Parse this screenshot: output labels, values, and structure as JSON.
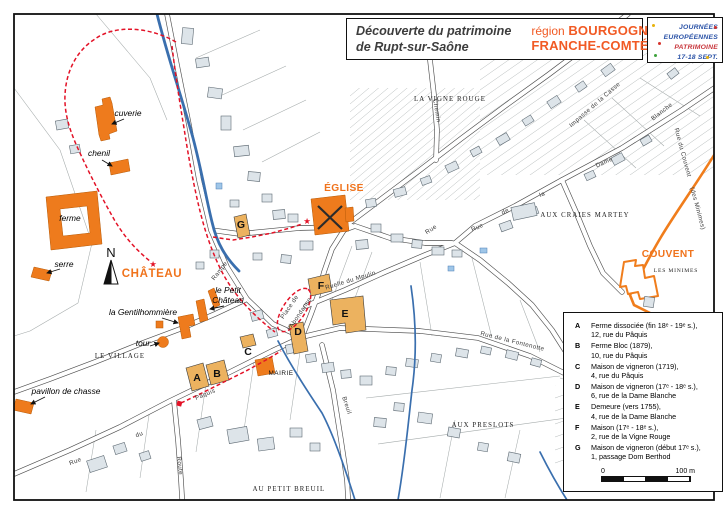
{
  "header": {
    "title_line1": "Découverte du patrimoine",
    "title_line2": "de Rupt-sur-Saône",
    "region_prefix": "région",
    "region_name1": "BOURGOGNE",
    "region_name2": "FRANCHE-COMTÉ",
    "accent_color": "#f15a24"
  },
  "logo": {
    "line1": "JOURNÉES",
    "line2": "EUROPÉENNES",
    "line3": "PATRIMOINE",
    "line4": "17-18 SEPT."
  },
  "legend": {
    "items": [
      {
        "letter": "A",
        "line1": "Ferme dissociée (fin 18ᵉ - 19ᵉ s.),",
        "line2": "12, rue du Pâquis"
      },
      {
        "letter": "B",
        "line1": "Ferme Bloc (1879),",
        "line2": "10, rue du Pâquis"
      },
      {
        "letter": "C",
        "line1": "Maison de vigneron (1719),",
        "line2": "4, rue du Pâquis"
      },
      {
        "letter": "D",
        "line1": "Maison de vigneron (17ᵉ - 18ᵉ s.),",
        "line2": "6, rue de la Dame Blanche"
      },
      {
        "letter": "E",
        "line1": "Demeure (vers 1755),",
        "line2": "4, rue de la Dame Blanche"
      },
      {
        "letter": "F",
        "line1": "Maison (17ᵉ - 18ᵉ s.),",
        "line2": "2, rue de la Vigne Rouge"
      },
      {
        "letter": "G",
        "line1": "Maison de vigneron (début 17ᵉ s.),",
        "line2": "1, passage Dom Berthod"
      }
    ],
    "scale_start": "0",
    "scale_end": "100 m"
  },
  "map": {
    "colors": {
      "heritage_orange": "#ee7b1d",
      "lettered_tan": "#ecb25f",
      "route_red": "#e31227",
      "water_blue": "#3a6fae",
      "building_gray": "#dde4e9"
    },
    "north_letter": "N",
    "building_letters": [
      {
        "letter": "A",
        "x": 197,
        "y": 381
      },
      {
        "letter": "B",
        "x": 217,
        "y": 377
      },
      {
        "letter": "C",
        "x": 248,
        "y": 355
      },
      {
        "letter": "D",
        "x": 298,
        "y": 335
      },
      {
        "letter": "E",
        "x": 345,
        "y": 317
      },
      {
        "letter": "F",
        "x": 321,
        "y": 289
      },
      {
        "letter": "G",
        "x": 241,
        "y": 228
      }
    ],
    "labels": [
      {
        "name": "label-chateau",
        "text": "CHÂTEAU",
        "x": 152,
        "y": 277,
        "cls": "poi-orange-lg"
      },
      {
        "name": "label-eglise",
        "text": "ÉGLISE",
        "x": 344,
        "y": 191,
        "cls": "poi-orange"
      },
      {
        "name": "label-couvent",
        "text": "COUVENT",
        "x": 668,
        "y": 257,
        "cls": "poi-orange"
      },
      {
        "name": "label-cuverie",
        "text": "cuverie",
        "x": 128,
        "y": 116,
        "cls": "poi"
      },
      {
        "name": "label-chenil",
        "text": "chenil",
        "x": 99,
        "y": 156,
        "cls": "poi"
      },
      {
        "name": "label-ferme",
        "text": "ferme",
        "x": 70,
        "y": 221,
        "cls": "poi"
      },
      {
        "name": "label-serre",
        "text": "serre",
        "x": 64,
        "y": 267,
        "cls": "poi"
      },
      {
        "name": "label-tour",
        "text": "tour",
        "x": 143,
        "y": 346,
        "cls": "poi"
      },
      {
        "name": "label-pavillon-de-chasse",
        "text": "pavillon de chasse",
        "x": 66,
        "y": 394,
        "cls": "poi"
      },
      {
        "name": "label-la-gentilhommiere",
        "text": "la Gentilhommière",
        "x": 143,
        "y": 315,
        "cls": "poi"
      },
      {
        "name": "label-le-petit-chateau-1",
        "text": "le Petit",
        "x": 228,
        "y": 293,
        "cls": "poi"
      },
      {
        "name": "label-le-petit-chateau-2",
        "text": "Château",
        "x": 228,
        "y": 303,
        "cls": "poi"
      },
      {
        "name": "label-mairie",
        "text": "MAIRIE",
        "x": 281,
        "y": 375,
        "cls": "mairie"
      },
      {
        "name": "label-le-village",
        "text": "LE VILLAGE",
        "x": 120,
        "y": 358,
        "cls": "area"
      },
      {
        "name": "label-la-vigne-rouge",
        "text": "LA VIGNE ROUGE",
        "x": 450,
        "y": 101,
        "cls": "area"
      },
      {
        "name": "label-aux-craies-martey",
        "text": "AUX CRAIES MARTEY",
        "x": 585,
        "y": 217,
        "cls": "area"
      },
      {
        "name": "label-aux-preslots",
        "text": "AUX PRESLOTS",
        "x": 483,
        "y": 427,
        "cls": "area"
      },
      {
        "name": "label-au-petit-breuil",
        "text": "AU PETIT BREUIL",
        "x": 289,
        "y": 491,
        "cls": "area"
      },
      {
        "name": "label-les-minimes",
        "text": "LES MINIMES",
        "x": 676,
        "y": 272,
        "cls": "area-sm"
      },
      {
        "name": "street-rampe",
        "text": "Rampe",
        "x": 221,
        "y": 272,
        "rot": -52,
        "cls": "street"
      },
      {
        "name": "street-paquis",
        "text": "Pâquis",
        "x": 206,
        "y": 396,
        "rot": -23,
        "cls": "street"
      },
      {
        "name": "street-du",
        "text": "du",
        "x": 140,
        "y": 436,
        "rot": -21,
        "cls": "street"
      },
      {
        "name": "street-rue",
        "text": "Rue",
        "x": 76,
        "y": 463,
        "rot": -21,
        "cls": "street"
      },
      {
        "name": "street-route",
        "text": "Route",
        "x": 178,
        "y": 466,
        "rot": 83,
        "cls": "street"
      },
      {
        "name": "street-breuil",
        "text": "Breuil",
        "x": 345,
        "y": 406,
        "rot": 72,
        "cls": "street"
      },
      {
        "name": "street-place-de",
        "text": "Place de",
        "x": 291,
        "y": 308,
        "rot": -56,
        "cls": "street"
      },
      {
        "name": "street-l-abondance",
        "text": "l'Abondance",
        "x": 301,
        "y": 315,
        "rot": -56,
        "cls": "street"
      },
      {
        "name": "street-ruelle-du-moulin",
        "text": "Ruelle  du  Moulin",
        "x": 351,
        "y": 282,
        "rot": -17,
        "cls": "street"
      },
      {
        "name": "street-rue-de-la-fontenotte",
        "text": "Rue  de  la  Fontenotte",
        "x": 512,
        "y": 343,
        "rot": 14,
        "cls": "street"
      },
      {
        "name": "street-rue-dame-blanche-1",
        "text": "Rue",
        "x": 478,
        "y": 229,
        "rot": -24,
        "cls": "street"
      },
      {
        "name": "street-rue-dame-blanche-2",
        "text": "de",
        "x": 506,
        "y": 213,
        "rot": -24,
        "cls": "street"
      },
      {
        "name": "street-rue-dame-blanche-3",
        "text": "la",
        "x": 543,
        "y": 196,
        "rot": -24,
        "cls": "street"
      },
      {
        "name": "street-rue-dame-blanche-4",
        "text": "Dame",
        "x": 605,
        "y": 164,
        "rot": -24,
        "cls": "street"
      },
      {
        "name": "street-rue-dame-blanche-5",
        "text": "Blanche",
        "x": 663,
        "y": 113,
        "rot": -38,
        "cls": "street"
      },
      {
        "name": "street-rue-du-couvent",
        "text": "Rue du Couvent",
        "x": 681,
        "y": 153,
        "rot": 75,
        "cls": "street"
      },
      {
        "name": "street-des-minimes",
        "text": "(des Minimes)",
        "x": 696,
        "y": 209,
        "rot": 75,
        "cls": "street"
      },
      {
        "name": "street-chemin",
        "text": "Chemin",
        "x": 435,
        "y": 111,
        "rot": 80,
        "cls": "street"
      },
      {
        "name": "street-impasse",
        "text": "Impasse de la Casse",
        "x": 596,
        "y": 106,
        "rot": -41,
        "cls": "street"
      },
      {
        "name": "street-rue-2",
        "text": "Rue",
        "x": 432,
        "y": 231,
        "rot": -33,
        "cls": "street"
      },
      {
        "name": "route-star-eglise",
        "text": "★",
        "x": 307,
        "y": 224,
        "cls": "star"
      },
      {
        "name": "route-star-chateau",
        "text": "★",
        "x": 153,
        "y": 267,
        "cls": "star"
      }
    ]
  }
}
